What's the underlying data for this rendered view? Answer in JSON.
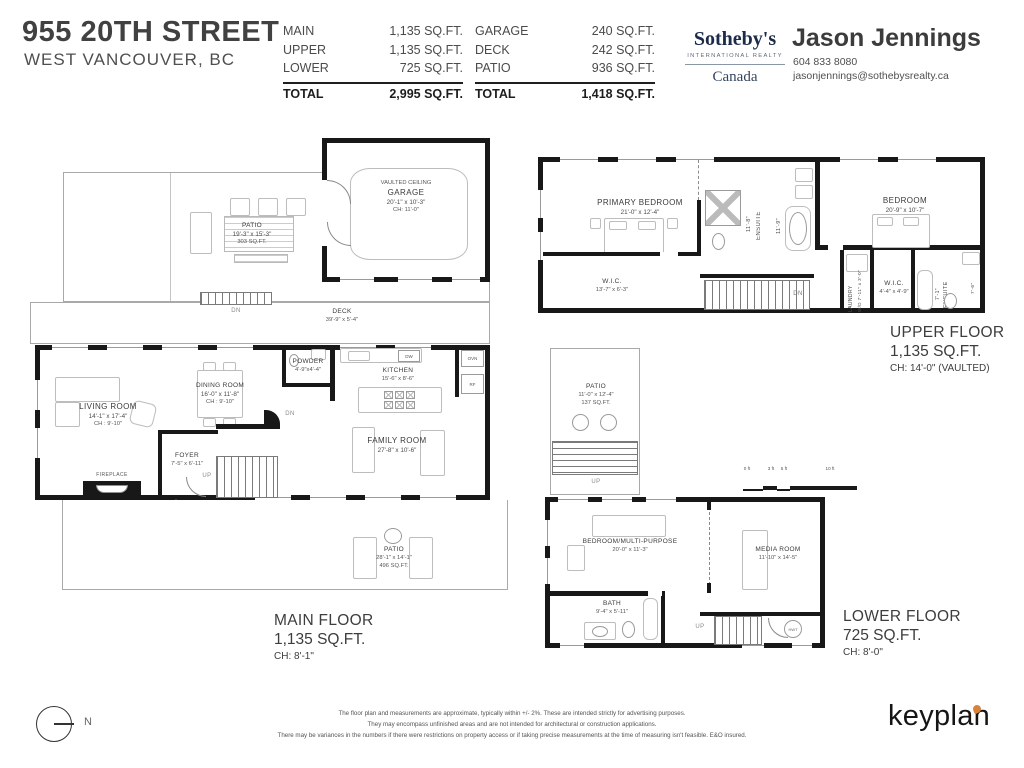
{
  "header": {
    "address_line1": "955 20TH STREET",
    "address_line2": "WEST VANCOUVER, BC",
    "areas_left": {
      "rows": [
        {
          "label": "MAIN",
          "value": "1,135 SQ.FT."
        },
        {
          "label": "UPPER",
          "value": "1,135 SQ.FT."
        },
        {
          "label": "LOWER",
          "value": "725 SQ.FT."
        }
      ],
      "total_label": "TOTAL",
      "total_value": "2,995 SQ.FT."
    },
    "areas_right": {
      "rows": [
        {
          "label": "GARAGE",
          "value": "240 SQ.FT."
        },
        {
          "label": "DECK",
          "value": "242 SQ.FT."
        },
        {
          "label": "PATIO",
          "value": "936 SQ.FT."
        }
      ],
      "total_label": "TOTAL",
      "total_value": "1,418 SQ.FT."
    },
    "brokerage": {
      "name": "Sotheby's",
      "tagline": "INTERNATIONAL REALTY",
      "country": "Canada"
    },
    "agent": {
      "name": "Jason Jennings",
      "phone": "604 833 8080",
      "email": "jasonjennings@sothebysrealty.ca"
    }
  },
  "main_floor": {
    "title": "MAIN FLOOR",
    "area": "1,135 SQ.FT.",
    "ceiling": "CH: 8'-1\"",
    "garage": {
      "note": "VAULTED CEILING",
      "name": "GARAGE",
      "dims": "20'-1\" x 10'-3\"",
      "ch": "CH: 11'-0\""
    },
    "patio_top": {
      "name": "PATIO",
      "dims": "19'-3\" x 15'-3\"",
      "area": "303 SQ.FT."
    },
    "deck": {
      "name": "DECK",
      "dims": "39'-9\" x 5'-4\""
    },
    "living": {
      "name": "LIVING ROOM",
      "dims": "14'-1\" x 17'-4\"",
      "ch": "CH : 9'-10\""
    },
    "dining": {
      "name": "DINING ROOM",
      "dims": "16'-0\" x 11'-8\"",
      "ch": "CH : 9'-10\""
    },
    "powder": {
      "name": "POWDER",
      "dims": "4'-9\"x4'-4\""
    },
    "kitchen": {
      "name": "KITCHEN",
      "dims": "15'-6\" x 8'-6\""
    },
    "family": {
      "name": "FAMILY ROOM",
      "dims": "27'-8\" x 10'-6\""
    },
    "foyer": {
      "name": "FOYER",
      "dims": "7'-5\" x 6'-11\""
    },
    "patio_bottom": {
      "name": "PATIO",
      "dims": "28'-1\" x 14'-1\"",
      "area": "496 SQ.FT."
    },
    "fireplace_label": "FIREPLACE",
    "appliances": {
      "dw": "DW",
      "ovn": "OVN",
      "rf": "RF"
    },
    "markers": {
      "dn_deck": "DN",
      "dn_stairs": "DN",
      "up": "UP",
      "ent": "ENT"
    }
  },
  "upper_floor": {
    "title": "UPPER FLOOR",
    "area": "1,135 SQ.FT.",
    "ceiling": "CH: 14'-0\" (VAULTED)",
    "primary_bedroom": {
      "name": "PRIMARY BEDROOM",
      "dims": "21'-0\" x 12'-4\""
    },
    "ensuite1": {
      "name": "ENSUITE",
      "dims": "11'-8\"",
      "dims2": "11'-9\""
    },
    "wic1": {
      "name": "W.I.C.",
      "dims": "13'-7\" x 6'-3\""
    },
    "bedroom": {
      "name": "BEDROOM",
      "dims": "20'-9\" x 10'-7\""
    },
    "laundry": {
      "name": "LAUNDRY",
      "dims": "W/D 7'-11\" x 3'-0\""
    },
    "wic2": {
      "name": "W.I.C.",
      "dims": "4'-4\" x 4'-9\""
    },
    "ensuite2": {
      "name": "ENSUITE",
      "dims": "7'-1\"",
      "dims2": "7'-6\""
    },
    "markers": {
      "dn": "DN"
    }
  },
  "entry_patio": {
    "name": "PATIO",
    "dims": "11'-0\" x 12'-4\"",
    "area": "137 SQ.FT.",
    "up": "UP"
  },
  "lower_floor": {
    "title": "LOWER FLOOR",
    "area": "725 SQ.FT.",
    "ceiling": "CH: 8'-0\"",
    "bedroom_multi": {
      "name": "BEDROOM/MULTI-PURPOSE",
      "dims": "20'-0\" x 11'-3\""
    },
    "media": {
      "name": "MEDIA ROOM",
      "dims": "11'-10\" x 14'-5\""
    },
    "bath": {
      "name": "BATH",
      "dims": "9'-4\" x 5'-11\""
    },
    "hwt": "HWT",
    "markers": {
      "up": "UP"
    }
  },
  "scale_bar": {
    "t0": "0 ft",
    "t3": "3 ft",
    "t5": "5 ft",
    "t10": "10 ft"
  },
  "footer": {
    "north_label": "N",
    "disclaimer_line1": "The floor plan and measurements are approximate, typically within +/- 2%. These are intended strictly for advertising purposes.",
    "disclaimer_line2": "They may encompass unfinished areas and are not intended for architectural or construction applications.",
    "disclaimer_line3": "There may be variances in the numbers if there were restrictions on property access or if taking precise measurements at the time of measuring isn't feasible. E&O insured.",
    "logo": "keyplan"
  },
  "colors": {
    "accent_orange": "#E8953C",
    "keyplan_pin": "#D9823C",
    "sothebys_navy": "#1B2B49",
    "wall": "#181818"
  }
}
